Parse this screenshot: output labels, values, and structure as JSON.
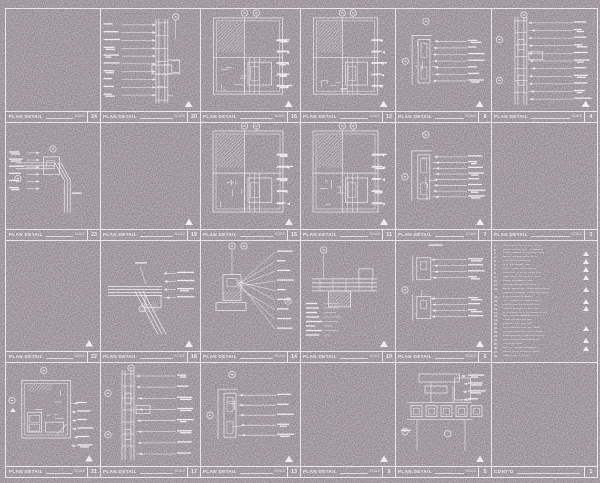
{
  "sheet": {
    "background_color": "#8b8288",
    "line_color": "#f1eef2",
    "title_label": "PLAN DETAIL",
    "scale_label": "SCALE",
    "panel_count": 24
  },
  "panels": [
    {
      "number": "24",
      "title": "PLAN DETAIL",
      "scale": "SCALE",
      "variant": "empty",
      "leaders": 0,
      "tri": false
    },
    {
      "number": "20",
      "title": "PLAN DETAIL",
      "scale": "SCALE",
      "variant": "vert-left",
      "leaders": 10,
      "tri": true
    },
    {
      "number": "16",
      "title": "PLAN DETAIL",
      "scale": "SCALE",
      "variant": "complex",
      "leaders": 6,
      "tri": true
    },
    {
      "number": "12",
      "title": "PLAN DETAIL",
      "scale": "SCALE",
      "variant": "complex",
      "leaders": 5,
      "tri": true
    },
    {
      "number": "8",
      "title": "PLAN DETAIL",
      "scale": "SCALE",
      "variant": "small-right",
      "leaders": 7,
      "tri": true
    },
    {
      "number": "4",
      "title": "PLAN DETAIL",
      "scale": "SCALE",
      "variant": "vert-right",
      "leaders": 11,
      "tri": true
    },
    {
      "number": "23",
      "title": "PLAN DETAIL",
      "scale": "SCALE",
      "variant": "pipe-left",
      "leaders": 6,
      "tri": false
    },
    {
      "number": "19",
      "title": "PLAN DETAIL",
      "scale": "SCALE",
      "variant": "empty",
      "leaders": 0,
      "tri": true
    },
    {
      "number": "15",
      "title": "PLAN DETAIL",
      "scale": "SCALE",
      "variant": "complex",
      "leaders": 5,
      "tri": true
    },
    {
      "number": "11",
      "title": "PLAN DETAIL",
      "scale": "SCALE",
      "variant": "complex",
      "leaders": 6,
      "tri": true
    },
    {
      "number": "7",
      "title": "PLAN DETAIL",
      "scale": "SCALE",
      "variant": "small-right",
      "leaders": 8,
      "tri": true
    },
    {
      "number": "3",
      "title": "PLAN DETAIL",
      "scale": "SCALE",
      "variant": "corner-right",
      "leaders": 8,
      "tri": false
    },
    {
      "number": "22",
      "title": "PLAN DETAIL",
      "scale": "SCALE",
      "variant": "corner-right",
      "leaders": 7,
      "tri": true
    },
    {
      "number": "18",
      "title": "PLAN DETAIL",
      "scale": "SCALE",
      "variant": "pipe-diag",
      "leaders": 4,
      "tri": true
    },
    {
      "number": "14",
      "title": "PLAN DETAIL",
      "scale": "SCALE",
      "variant": "radial",
      "leaders": 9,
      "tri": false
    },
    {
      "number": "10",
      "title": "PLAN DETAIL",
      "scale": "SCALE",
      "variant": "wide-left",
      "leaders": 8,
      "tri": true
    },
    {
      "number": "6",
      "title": "PLAN DETAIL",
      "scale": "SCALE",
      "variant": "stacked",
      "leaders": 8,
      "tri": true
    },
    {
      "number": "2",
      "title": "",
      "scale": "",
      "variant": "keynotes",
      "leaders": 0,
      "tri": false
    },
    {
      "number": "21",
      "title": "PLAN DETAIL",
      "scale": "SCALE",
      "variant": "room",
      "leaders": 6,
      "tri": true
    },
    {
      "number": "17",
      "title": "PLAN DETAIL",
      "scale": "SCALE",
      "variant": "vert-right",
      "leaders": 8,
      "tri": false
    },
    {
      "number": "13",
      "title": "PLAN DETAIL",
      "scale": "SCALE",
      "variant": "small-right",
      "leaders": 5,
      "tri": true
    },
    {
      "number": "9",
      "title": "PLAN DETAIL",
      "scale": "SCALE",
      "variant": "corner-right",
      "leaders": 7,
      "tri": true
    },
    {
      "number": "5",
      "title": "PLAN DETAIL",
      "scale": "SCALE",
      "variant": "grid",
      "leaders": 5,
      "tri": true
    },
    {
      "number": "1",
      "title": "CONT'D",
      "scale": "",
      "variant": "empty",
      "leaders": 0,
      "tri": false
    }
  ],
  "keynotes": {
    "lines": [
      {
        "code": "1.",
        "text": "5/8 IN. GYP. BD. O/ MTL. STUD",
        "tri": false
      },
      {
        "code": "2.",
        "text": "EXIST. CONC. COL. TO REMAIN",
        "tri": false
      },
      {
        "code": "3.",
        "text": "CONT. SEALANT AND BKR. ROD",
        "tri": true
      },
      {
        "code": "4.",
        "text": "ALUM. STOREFRONT SYS.",
        "tri": false
      },
      {
        "code": "5.",
        "text": "1 IN. INSUL. GLAZING",
        "tri": true
      },
      {
        "code": "6.",
        "text": "MTL. CLOSURE TRIM",
        "tri": false
      },
      {
        "code": "7.",
        "text": "BATT INSUL. FULL DEPTH",
        "tri": true
      },
      {
        "code": "8.",
        "text": "6 IN. MTL. STUD AT 16 IN. O.C.",
        "tri": false
      },
      {
        "code": "9.",
        "text": "CEM. PLASTER O/ MTL. LATH",
        "tri": true
      },
      {
        "code": "10.",
        "text": "WEEP SCREED AT SILL",
        "tri": false
      },
      {
        "code": "11.",
        "text": "FLASHING AND CONTROL JT.",
        "tri": false
      },
      {
        "code": "12.",
        "text": "EXIST. MASONRY WALL, PATCH AND",
        "tri": true
      },
      {
        "code": "",
        "text": "REPAIR AS REQD. TO MATCH EXIST.",
        "tri": false
      },
      {
        "code": "13.",
        "text": "2-HR RATED ASSEMBLY",
        "tri": false
      },
      {
        "code": "14.",
        "text": "STL. TUBE COL. SEE STRUCT.",
        "tri": true
      },
      {
        "code": "15.",
        "text": "ANCHOR BOLT AT 24 IN. O.C.",
        "tri": false
      },
      {
        "code": "16.",
        "text": "SHIM AS REQD. AT EA. CLIP",
        "tri": true
      },
      {
        "code": "17.",
        "text": "MTL. PANEL SYS. W/ CONC. CLIPS",
        "tri": false
      },
      {
        "code": "18.",
        "text": "AIR / VAPOR BARRIER CONT.",
        "tri": false
      },
      {
        "code": "19.",
        "text": "RIGID INSUL. R-10 MIN.",
        "tri": false
      },
      {
        "code": "20.",
        "text": "PREFIN. MTL. COPING",
        "tri": false
      },
      {
        "code": "21.",
        "text": "STL. ANGLE CONT. EA. SIDE",
        "tri": true
      },
      {
        "code": "22.",
        "text": "ACOUS. SEALANT BOTH SIDES",
        "tri": false
      },
      {
        "code": "23.",
        "text": "FIRE SAFING AT DECK FLUTES",
        "tri": false
      },
      {
        "code": "24.",
        "text": "HM. DOOR FRAME BEYOND",
        "tri": true
      },
      {
        "code": "25.",
        "text": "FIN. FLR. LINE",
        "tri": false
      },
      {
        "code": "26.",
        "text": "EXP. JT. COVER ASSEMBLY",
        "tri": true
      },
      {
        "code": "27.",
        "text": "ALIGN FACE W/ EXIST. WALL",
        "tri": false
      },
      {
        "code": "28.",
        "text": "SEE STRUCT. DWGS.",
        "tri": false
      }
    ]
  }
}
